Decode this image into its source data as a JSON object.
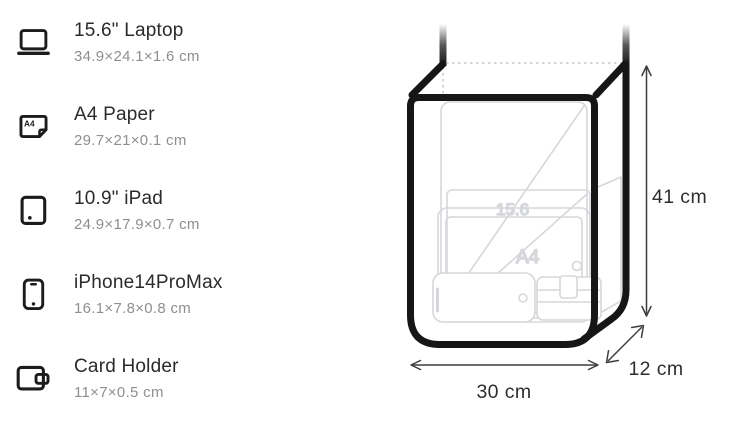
{
  "spec_list": {
    "items": [
      {
        "icon": "laptop-icon",
        "name": "15.6\" Laptop",
        "dims": "34.9×24.1×1.6 cm"
      },
      {
        "icon": "a4-paper-icon",
        "name": "A4 Paper",
        "dims": "29.7×21×0.1 cm",
        "icon_label": "A4"
      },
      {
        "icon": "tablet-icon",
        "name": "10.9\" iPad",
        "dims": "24.9×17.9×0.7 cm"
      },
      {
        "icon": "phone-icon",
        "name": "iPhone14ProMax",
        "dims": "16.1×7.8×0.8 cm"
      },
      {
        "icon": "wallet-icon",
        "name": "Card Holder",
        "dims": "11×7×0.5 cm"
      }
    ]
  },
  "diagram": {
    "dimensions": {
      "height": "41 cm",
      "width": "30 cm",
      "depth": "12 cm"
    },
    "inner_item_labels": {
      "laptop": "15.6",
      "a4_paper": "A4"
    },
    "colors": {
      "bag_outline": "#161616",
      "item_outline": "#d5d7da",
      "item_label": "#dbdde0",
      "dimension_text": "#2e2e2e",
      "arrow": "#3d3d3d",
      "dotted_edge": "#c9c9c9",
      "title_text": "#2b2b2b",
      "subtitle_text": "#8f8f8f"
    }
  }
}
